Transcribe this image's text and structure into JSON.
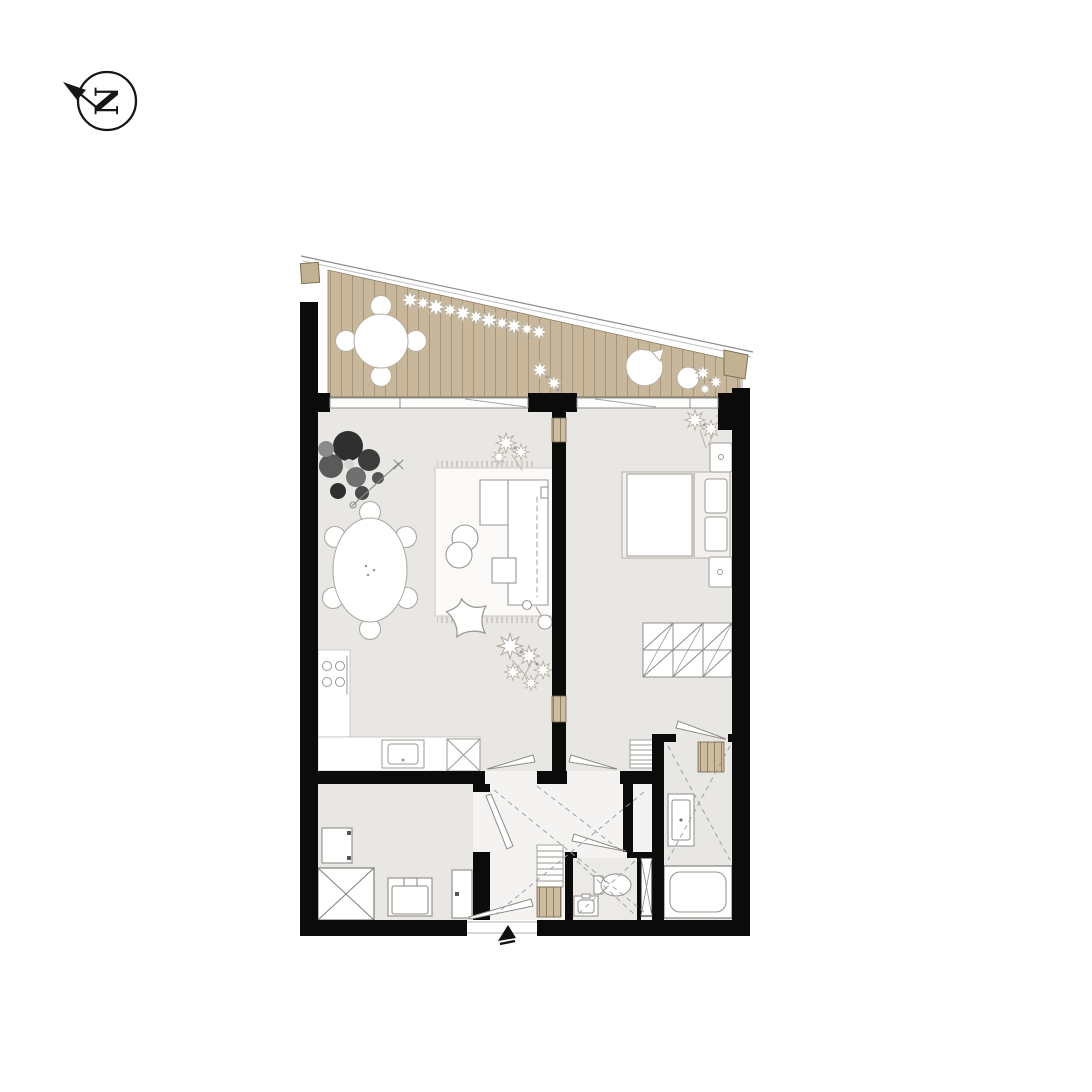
{
  "compass": {
    "letter": "N"
  },
  "colors": {
    "background": "#ffffff",
    "wall": "#0b0b0b",
    "deck": "#c8b79b",
    "deck_line": "#a3967b",
    "floor": "#e9e7e4",
    "floor_hall": "#f4f3f1",
    "floor_wc": "#eceae7",
    "shaft_tan": "#cdbc9d",
    "furniture_stroke": "#999999",
    "plant_dark": "#2f2f2f"
  },
  "plan": {
    "rooms": [
      {
        "name": "balcony"
      },
      {
        "name": "living-room-with-kitchen"
      },
      {
        "name": "bedroom"
      },
      {
        "name": "entrance-hall"
      },
      {
        "name": "utility-room"
      },
      {
        "name": "wc"
      },
      {
        "name": "bathroom"
      }
    ]
  }
}
